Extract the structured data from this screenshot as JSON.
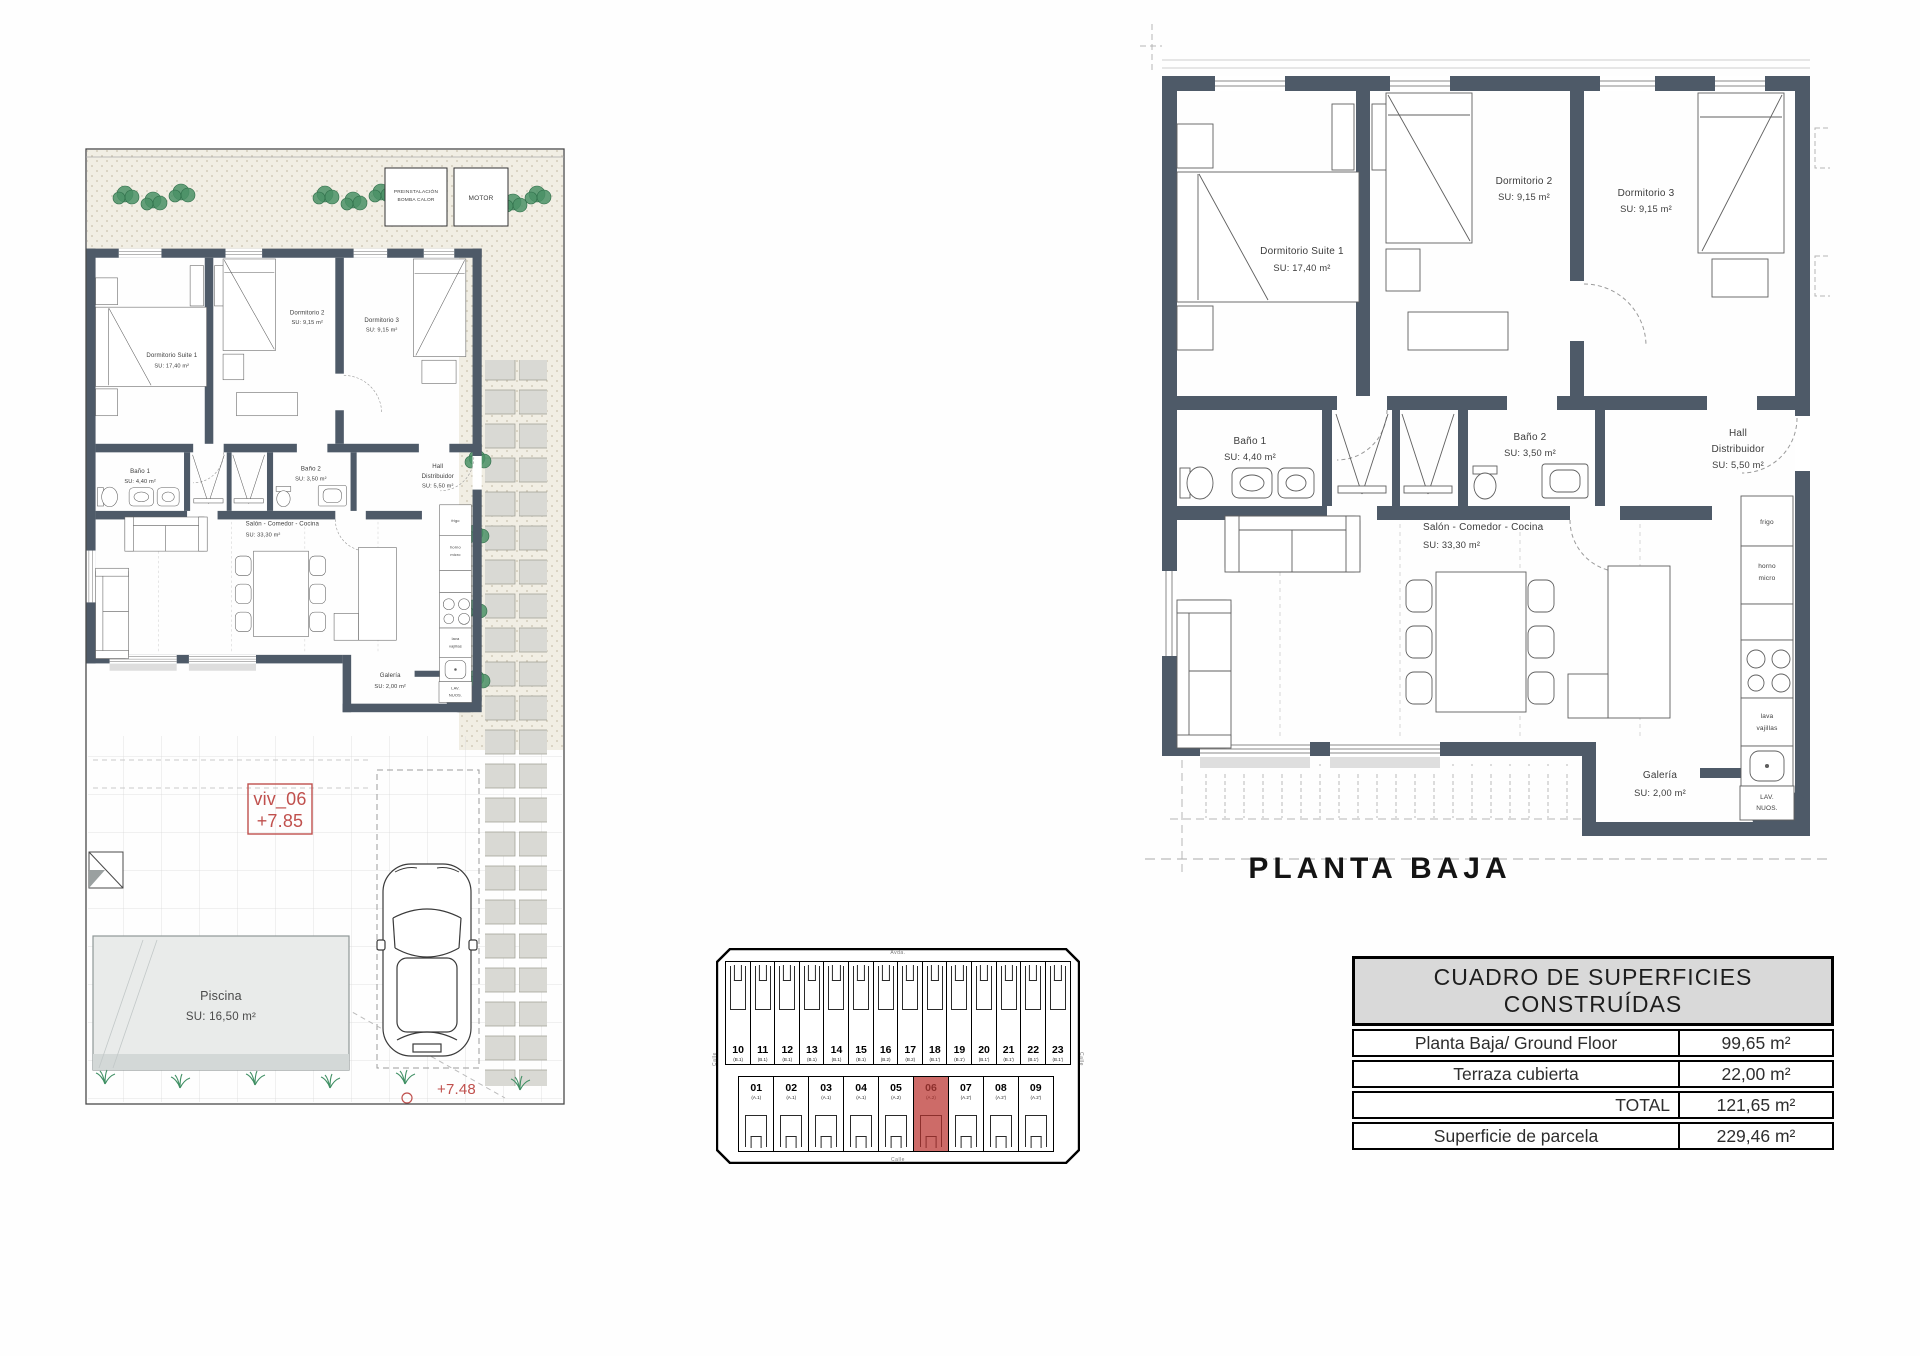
{
  "floor_title": "PLANTA BAJA",
  "rooms": {
    "suite": {
      "name": "Dormitorio Suite 1",
      "area": "SU: 17,40 m²"
    },
    "dorm2": {
      "name": "Dormitorio 2",
      "area": "SU: 9,15 m²"
    },
    "dorm3": {
      "name": "Dormitorio 3",
      "area": "SU: 9,15 m²"
    },
    "bano1": {
      "name": "Baño 1",
      "area": "SU: 4,40 m²"
    },
    "bano2": {
      "name": "Baño 2",
      "area": "SU: 3,50 m²"
    },
    "hall": {
      "line1": "Hall",
      "line2": "Distribuidor",
      "area": "SU: 5,50 m²"
    },
    "salon": {
      "name": "Salón - Comedor - Cocina",
      "area": "SU: 33,30 m²"
    },
    "galeria": {
      "name": "Galería",
      "area": "SU: 2,00 m²"
    }
  },
  "kitchen": {
    "fridge": "frigo",
    "oven_l1": "horno",
    "oven_l2": "micro",
    "dw_l1": "lava",
    "dw_l2": "vajillas",
    "laundry_l1": "LAV.",
    "laundry_l2": "NUOS."
  },
  "site": {
    "unit": "viv_06",
    "level": "+7.85",
    "level2": "+7.48",
    "pool_name": "Piscina",
    "pool_area": "SU: 16,50 m²",
    "equip1_l1": "PREINSTALACIÓN",
    "equip1_l2": "BOMBA CALOR",
    "equip2": "MOTOR"
  },
  "key_plan": {
    "highlight": "06",
    "street_top": "Avda.",
    "street_bottom": "Calle",
    "street_left": "Calle",
    "street_right": "Calle",
    "top_row": [
      {
        "num": "10",
        "type": "(B.1)"
      },
      {
        "num": "11",
        "type": "(B.1)"
      },
      {
        "num": "12",
        "type": "(B.1)"
      },
      {
        "num": "13",
        "type": "(B.1)"
      },
      {
        "num": "14",
        "type": "(B.1)"
      },
      {
        "num": "15",
        "type": "(B.1)"
      },
      {
        "num": "16",
        "type": "(B.2)"
      },
      {
        "num": "17",
        "type": "(B.2)"
      },
      {
        "num": "18",
        "type": "(B.1')"
      },
      {
        "num": "19",
        "type": "(B.1')"
      },
      {
        "num": "20",
        "type": "(B.1')"
      },
      {
        "num": "21",
        "type": "(B.1')"
      },
      {
        "num": "22",
        "type": "(B.1')"
      },
      {
        "num": "23",
        "type": "(B.1')"
      }
    ],
    "bottom_row": [
      {
        "num": "01",
        "type": "(A.1)"
      },
      {
        "num": "02",
        "type": "(A.1)"
      },
      {
        "num": "03",
        "type": "(A.1)"
      },
      {
        "num": "04",
        "type": "(A.1)"
      },
      {
        "num": "05",
        "type": "(A.2)"
      },
      {
        "num": "06",
        "type": "(A.2)"
      },
      {
        "num": "07",
        "type": "(A.2')"
      },
      {
        "num": "08",
        "type": "(A.2')"
      },
      {
        "num": "09",
        "type": "(A.2')"
      }
    ]
  },
  "table": {
    "title": "CUADRO DE SUPERFICIES CONSTRUÍDAS",
    "rows": [
      {
        "label": "Planta Baja/ Ground Floor",
        "value": "99,65 m²"
      },
      {
        "label": "Terraza cubierta",
        "value": "22,00 m²"
      },
      {
        "label": "TOTAL",
        "value": "121,65 m²"
      },
      {
        "label": "Superficie de parcela",
        "value": "229,46 m²"
      }
    ]
  },
  "colors": {
    "wall": "#4e5a68",
    "highlight_red": "#c0504d",
    "highlight_fill": "#cd6b68",
    "gravel": "#f1eee4",
    "paver": "#d9d9d4"
  }
}
